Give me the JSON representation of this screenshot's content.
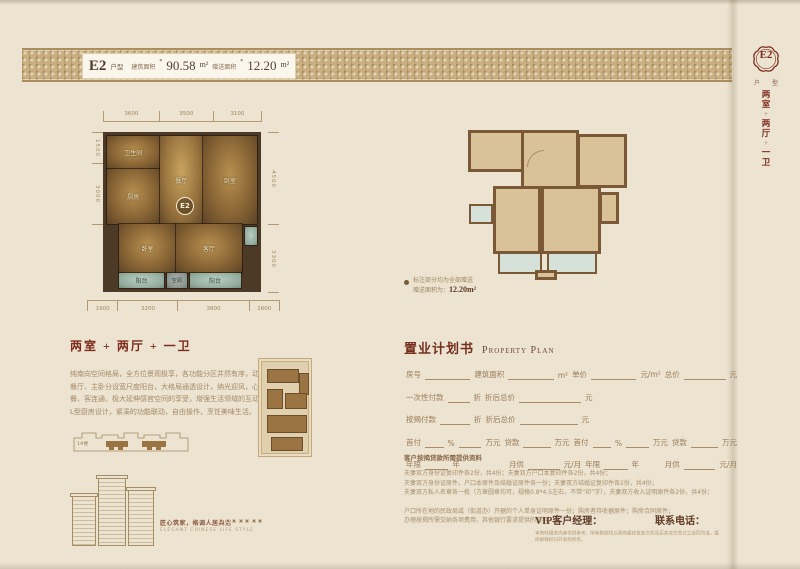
{
  "colors": {
    "accent": "#7c2b1e",
    "band": "#c9ae80",
    "paper": "#ece3d0",
    "wall_dark": "#4c3a27",
    "wall_outline": "#7b5937",
    "tan_fill": "#d9c198",
    "teal": "#d6e2d9",
    "text_brown": "#a58a68"
  },
  "header": {
    "unit": "E2",
    "unit_suffix": "户型",
    "area_label": "建筑面积",
    "area_approx": "*",
    "area_value": "90.58",
    "area_unit": "m²",
    "bonus_label": "赠送面积",
    "bonus_approx": "*",
    "bonus_value": "12.20",
    "bonus_unit": "m²"
  },
  "side_tab": {
    "unit": "E2",
    "unit_label": "户 型",
    "layout_chars": [
      "两",
      "室",
      "+",
      "两",
      "厅",
      "+",
      "一",
      "卫"
    ]
  },
  "floorplan": {
    "badge": "E2",
    "dims_top": [
      "3600",
      "3500",
      "3100"
    ],
    "dims_bottom": [
      "1600",
      "3200",
      "3800",
      "1600"
    ],
    "dims_left": [
      "1500",
      "3000"
    ],
    "dims_right": [
      "4500",
      "3300"
    ],
    "room_labels": {
      "bath": "卫生间",
      "kitchen": "厨房",
      "dining": "餐厅",
      "bedroom_right": "卧室",
      "bedroom_left": "卧室",
      "living": "客厅",
      "balcony_left": "阳台",
      "balcony_right": "阳台",
      "ac": "空调"
    }
  },
  "outline_plan": {
    "note_line1": "标注部分均为全部赠送",
    "note_line2_label": "赠送面积为：",
    "note_value": "12.20m²"
  },
  "description": {
    "title": "两室 + 两厅 + 一卫",
    "lines": [
      "纯南向空间格局，全方位景观极享，各功能分区井然有序，动线流畅；",
      "餐厅、主卧分设宽尺度阳台，大格局通透设计，纳光迎风，心境怡然；",
      "餐、客连通，极大延伸感官空间的享受，增强生活领域的互动性；",
      "L型厨房设计，紧凑的功能联动，自由操作，烹饪美味生活。"
    ]
  },
  "property_plan": {
    "title_cn": "置业计划书",
    "title_en": "Property Plan",
    "rows": [
      [
        {
          "t": "房号"
        },
        {
          "u": 50
        },
        {
          "t": "建筑面积"
        },
        {
          "u": 50
        },
        {
          "t": "m²"
        },
        {
          "t": "单价"
        },
        {
          "u": 50
        },
        {
          "t": "元/m²"
        },
        {
          "t": "总价"
        },
        {
          "u": 46
        },
        {
          "t": "元"
        }
      ],
      [
        {
          "t": "一次性付款"
        },
        {
          "u": 22
        },
        {
          "t": "折"
        },
        {
          "t": "折后总价"
        },
        {
          "u": 62
        },
        {
          "t": "元"
        }
      ],
      [
        {
          "t": "按揭付款"
        },
        {
          "u": 30
        },
        {
          "t": "折"
        },
        {
          "t": "折后总价"
        },
        {
          "u": 58
        },
        {
          "t": "元"
        }
      ],
      [
        {
          "t": "首付"
        },
        {
          "u": 26
        },
        {
          "t": "%"
        },
        {
          "u": 32
        },
        {
          "t": "万元"
        },
        {
          "t": "贷款"
        },
        {
          "u": 38
        },
        {
          "t": "万元"
        },
        {
          "t": "首付"
        },
        {
          "u": 26
        },
        {
          "t": "%"
        },
        {
          "u": 32
        },
        {
          "t": "万元"
        },
        {
          "t": "贷款"
        },
        {
          "u": 38
        },
        {
          "t": "万元"
        }
      ],
      [
        {
          "t": "年限"
        },
        {
          "u": 28
        },
        {
          "t": "年"
        },
        {
          "s": 54
        },
        {
          "t": "月供"
        },
        {
          "u": 38
        },
        {
          "t": "元/月"
        },
        {
          "t": "年限"
        },
        {
          "u": 28
        },
        {
          "t": "年"
        },
        {
          "s": 26
        },
        {
          "t": "月供"
        },
        {
          "u": 38
        },
        {
          "t": "元/月"
        }
      ]
    ]
  },
  "docs": {
    "heading": "客户按揭贷款所需提供资料",
    "lines": [
      "夫妻双方身份证复印件各2份，共4份；夫妻双方户口本复印件各2份，共4份；",
      "夫妻双方身份证原件，户口本原件及结婚证原件各一份；夫妻双方结婚证复印件各2份，共4份；",
      "夫妻双方私人名章各一枚（方章圆章均可，规格0.8*4.5左右，不带“印”字），夫妻双方收入证明原件各2份，共4份；"
    ],
    "lines2": [
      "户口所在地的民政局或（街道办）开据的个人单身证明原件一份；购房者持收据原件；购房合同原件；",
      "办理按揭所需交纳各项费用，其他银行要求提供的资料。"
    ],
    "vip_label": "VIP客户经理：",
    "phone_label": "联系电话：",
    "disclaimer": "本资料相关内容仅供参考，所有数据均以政府最终批准文件及买卖双方签订之合同为准，最终解释权归开发商所有。"
  },
  "footer": {
    "keyplan_label": "1#楼",
    "slogan_cn": "匠心筑家，格调人居典范",
    "slogan_en": "ELEGANT CHINESE LIFE STYLE",
    "squares": 7
  }
}
